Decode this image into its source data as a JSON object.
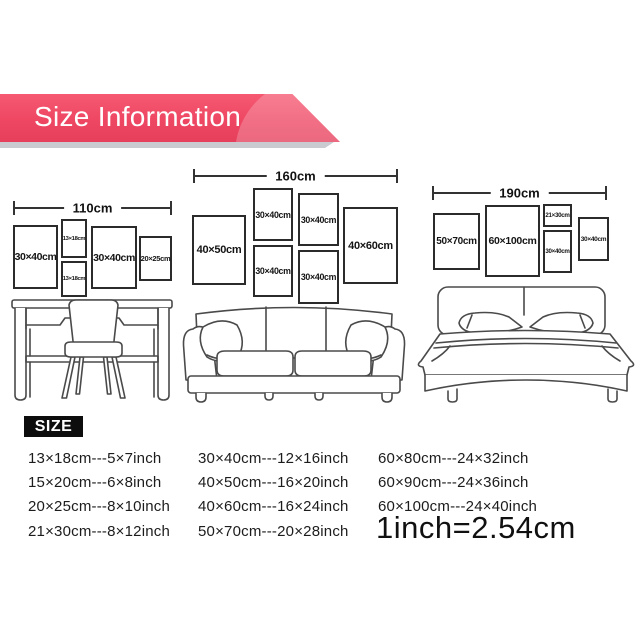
{
  "banner": {
    "title": "Size Information",
    "ribbon_color": "#ee4763",
    "shadow_color": "#c9cbd0"
  },
  "scenes": [
    {
      "name": "desk",
      "dimension_label": "110cm",
      "frames": [
        "30×40cm",
        "13×18cm",
        "13×18cm",
        "30×40cm",
        "20×25cm"
      ],
      "illustration": "desk-and-chair"
    },
    {
      "name": "sofa",
      "dimension_label": "160cm",
      "frames": [
        "40×50cm",
        "30×40cm",
        "30×40cm",
        "30×40cm",
        "30×40cm",
        "40×60cm"
      ],
      "illustration": "sofa"
    },
    {
      "name": "bed",
      "dimension_label": "190cm",
      "frames": [
        "50×70cm",
        "60×100cm",
        "21×30cm",
        "30×40cm",
        "30×40cm"
      ],
      "illustration": "double-bed"
    }
  ],
  "size_table": {
    "badge": "SIZE",
    "columns": [
      {
        "rows": [
          "13×18cm---5×7inch",
          "15×20cm---6×8inch",
          "20×25cm---8×10inch",
          "21×30cm---8×12inch"
        ]
      },
      {
        "rows": [
          "30×40cm---12×16inch",
          "40×50cm---16×20inch",
          "40×60cm---16×24inch",
          "50×70cm---20×28inch"
        ]
      },
      {
        "rows": [
          "60×80cm---24×32inch",
          "60×90cm---24×36inch",
          "60×100cm---24×40inch"
        ]
      }
    ],
    "conversion_note": "1inch=2.54cm"
  }
}
